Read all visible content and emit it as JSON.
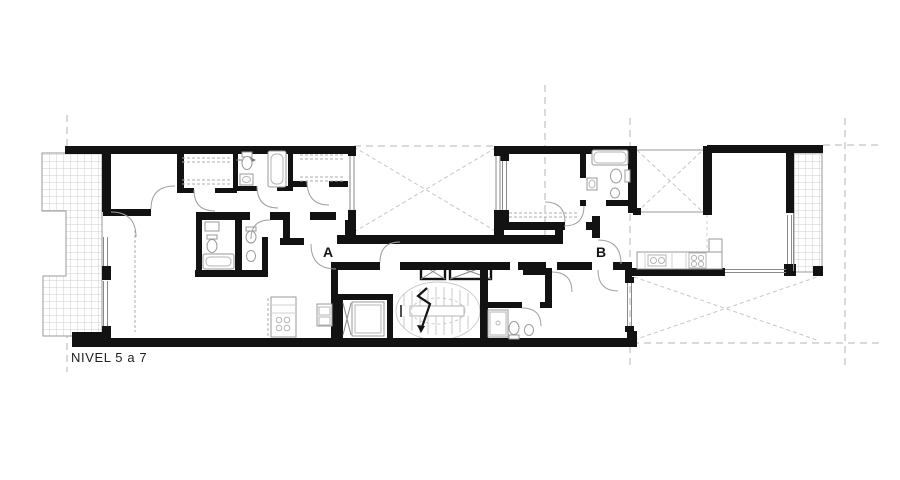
{
  "drawing": {
    "level_label": "NIVEL 5 a 7",
    "units": [
      {
        "label": "A"
      },
      {
        "label": "B"
      }
    ],
    "colors": {
      "background": "#ffffff",
      "wall": "#121212",
      "thin_line": "#8a8a8a",
      "grid_dash_line": "#b5b5b5",
      "void_cross_line": "#c6c6c6",
      "hatch_line": "#cfcfcf",
      "fixture_line": "#9a9a9a",
      "label_text": "#141414"
    }
  }
}
